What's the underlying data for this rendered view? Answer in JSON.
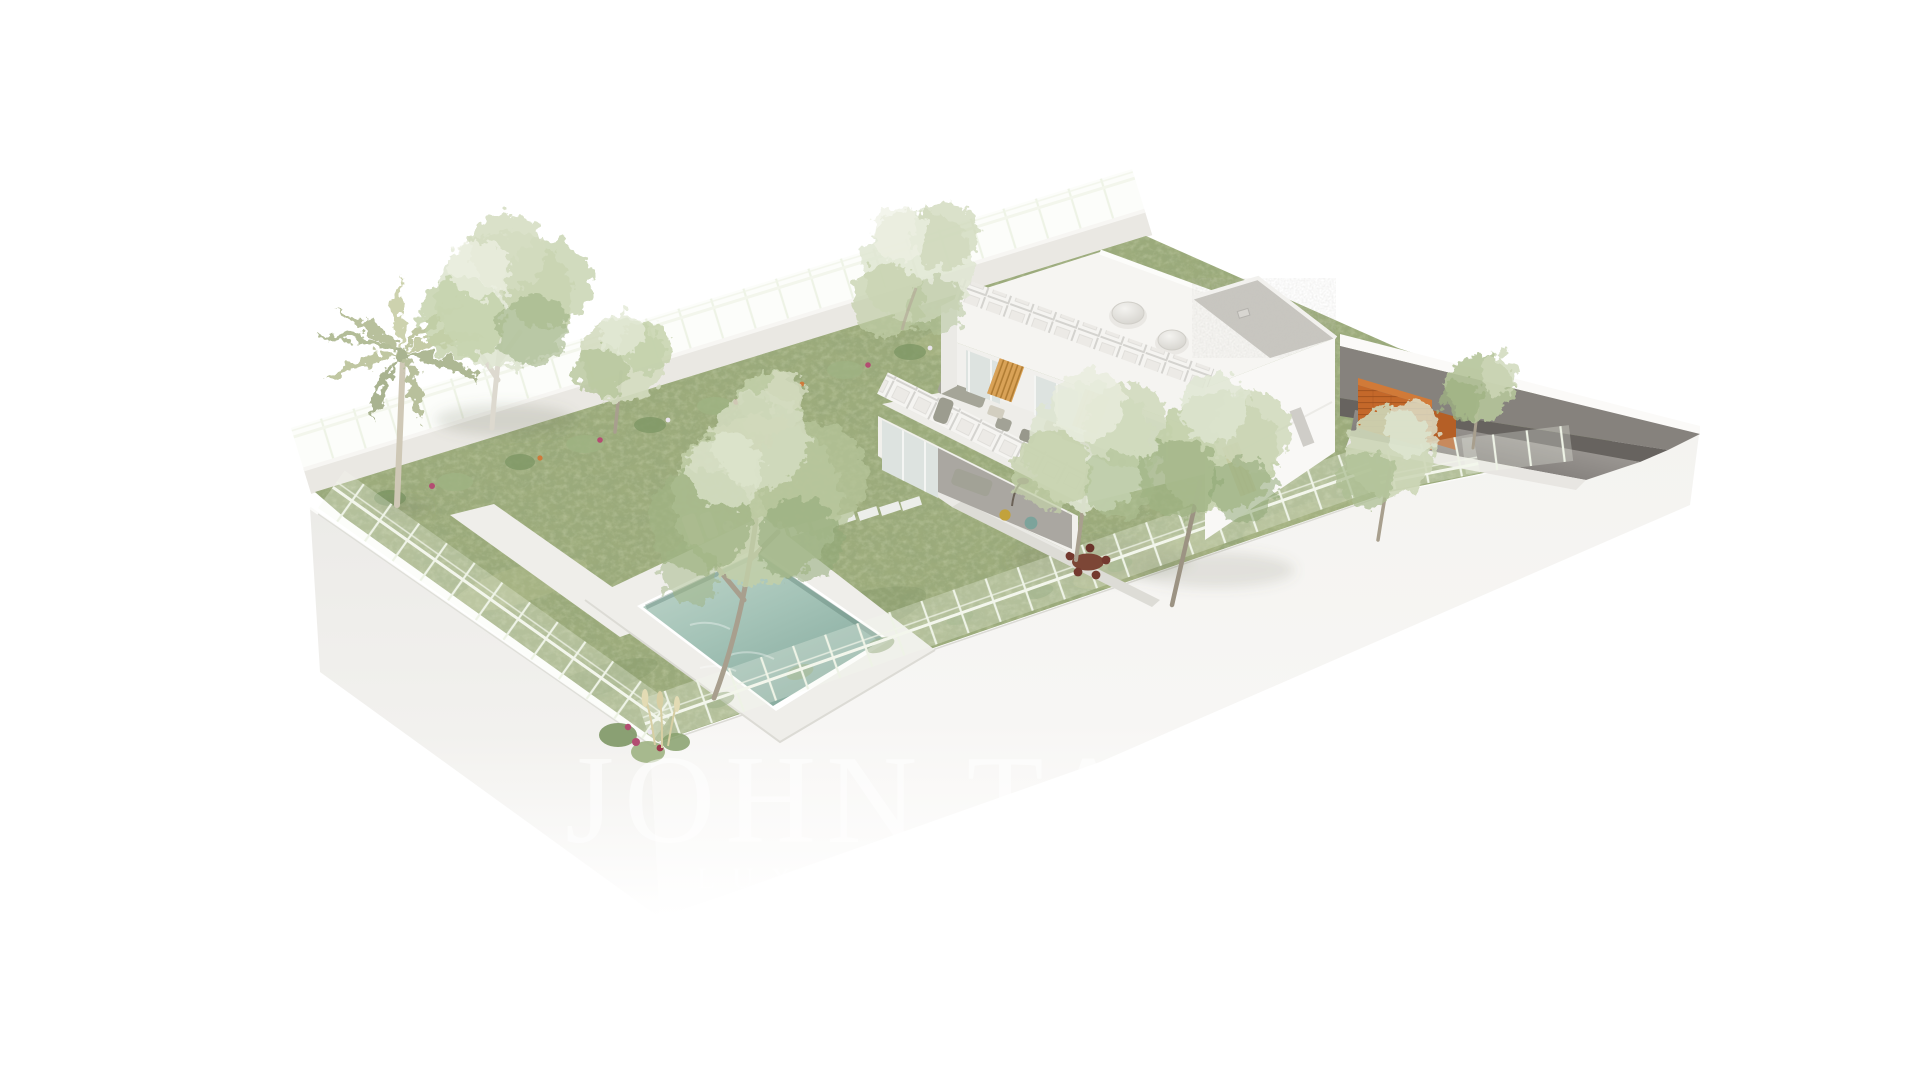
{
  "watermark": {
    "line1": "JOHN TA",
    "line2": "LUXUR",
    "color": "#ffffff"
  },
  "palette": {
    "background": "#ffffff",
    "plinth": "#f0efec",
    "plinth_bright": "#f5f4f1",
    "lawn": "#9dac7c",
    "lawn_light": "#b6c190",
    "lawn_dark": "#7e9263",
    "walkway": "#efeeea",
    "pool_shallow": "#c2d7cc",
    "pool_deep": "#86aa9e",
    "house_white": "#f5f4f1",
    "house_bright": "#f9f8f6",
    "house_shade": "#eae9e5",
    "roof": "#f6f5f2",
    "roof_gravel": "#c8c6c0",
    "glass": "#dde3e0",
    "louver": "#d9a257",
    "accent_orange": "#c4682a",
    "driveway": "#716d69",
    "retaining_wall": "#86827d",
    "boundary_wall": "#eae8e3",
    "fence": "#f2f5ea",
    "foliage_pale": "#dfe6d2",
    "foliage_light": "#c2cfa8",
    "foliage_mid": "#9fb383",
    "foliage_dark": "#7e9765",
    "palm": "#c5cba6",
    "trunk": "#a89f8e",
    "birch_bark": "#ddd9cf",
    "flower_magenta": "#b34d72",
    "flower_orange": "#cf7a3a",
    "pampas": "#d8cfa4",
    "furniture_gray": "#a2a296",
    "lounger_cream": "#ded7b8",
    "chair_red": "#74392f",
    "chair_teal": "#7ca39b",
    "pouf_yellow": "#c2a23c"
  }
}
